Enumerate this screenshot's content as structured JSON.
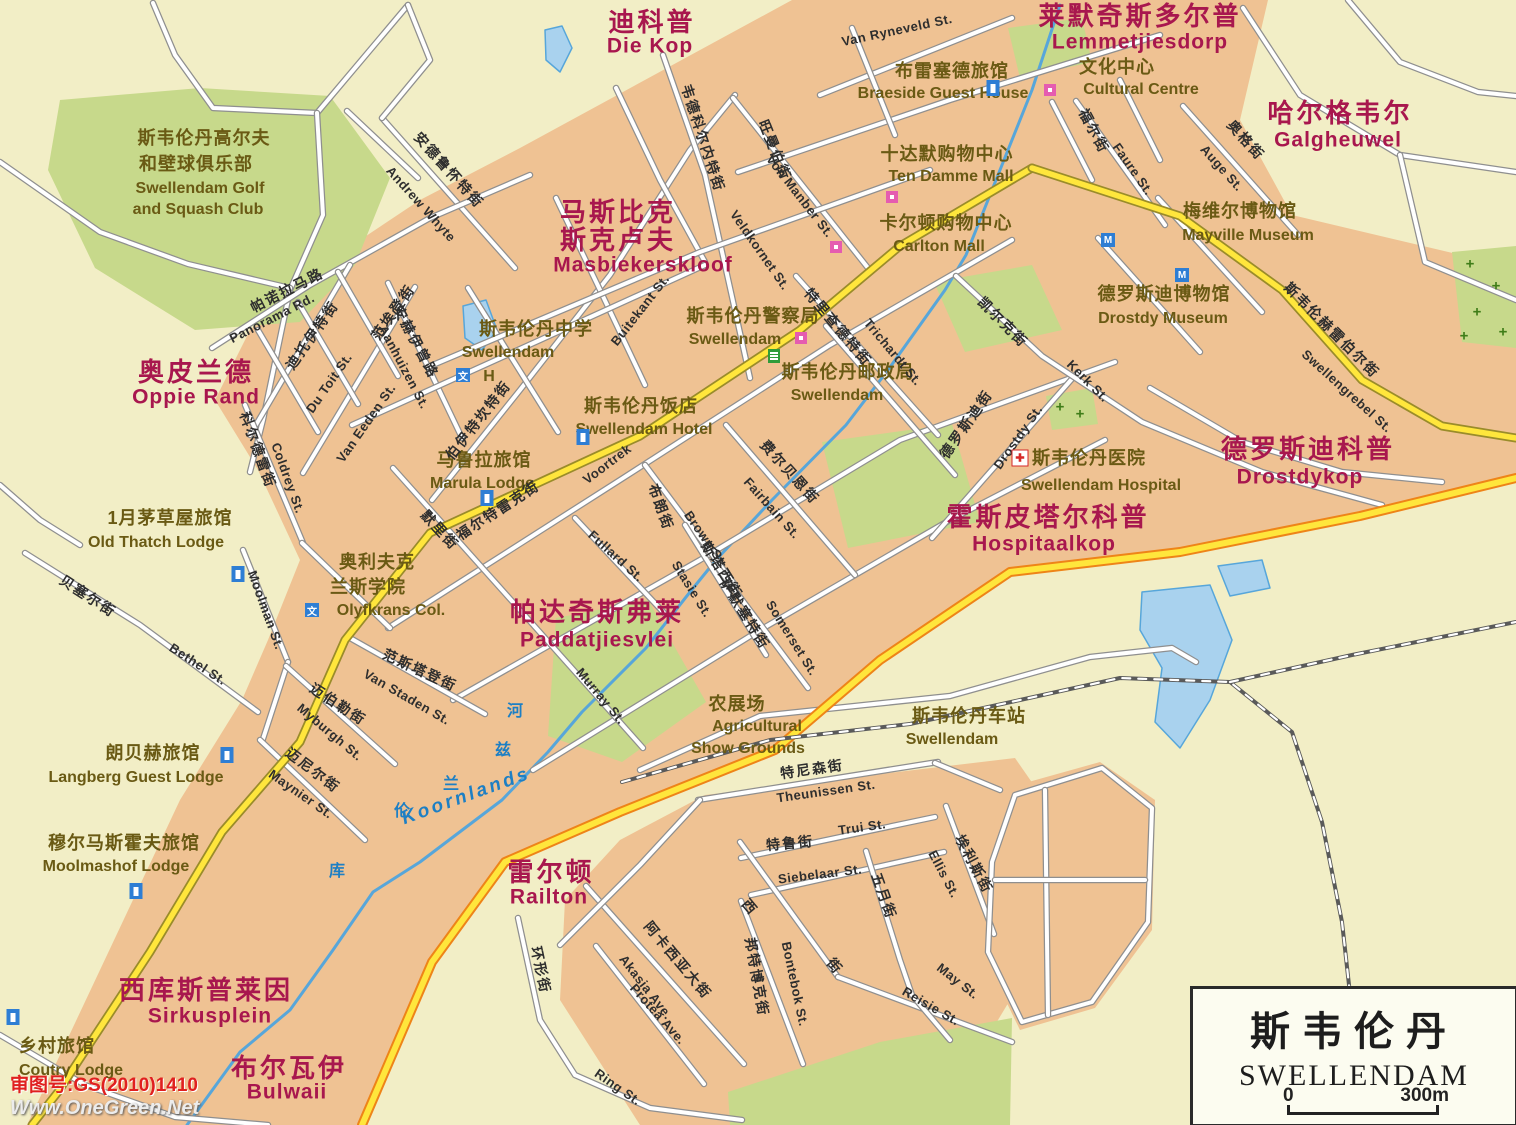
{
  "title_box": {
    "zh": "斯韦伦丹",
    "en": "SWELLENDAM",
    "scale_start": "0",
    "scale_end": "300m"
  },
  "credits": {
    "approval": "审图号:GS(2010)1410",
    "watermark": "Www.OneGreen.Net"
  },
  "colors": {
    "rural": "#f2eec6",
    "urban": "#efc293",
    "green": "#c7d98b",
    "water": "#a9d2ee",
    "river": "#57a6da",
    "roadc": "#8f8f8f",
    "yellow": "#ffe63c",
    "yellowc": "#9a8c2a",
    "hwyc": "#ee8418",
    "rail": "#5a5a5a",
    "district": "#a8174e",
    "poi": "#6a5a14",
    "street": "#2e2e2e",
    "waterlbl": "#1d7fc4",
    "approval": "#e02020",
    "watermark": "#ececec"
  },
  "labels": [
    {
      "t": "迪科普",
      "x": 652,
      "y": 22,
      "c": "dz"
    },
    {
      "t": "Die Kop",
      "x": 650,
      "y": 46,
      "c": "de"
    },
    {
      "t": "莱默奇斯多尔普",
      "x": 1140,
      "y": 16,
      "c": "dz"
    },
    {
      "t": "Lemmetjiesdorp",
      "x": 1140,
      "y": 42,
      "c": "de"
    },
    {
      "t": "哈尔格韦尔",
      "x": 1340,
      "y": 113,
      "c": "dz"
    },
    {
      "t": "Galgheuwel",
      "x": 1338,
      "y": 140,
      "c": "de"
    },
    {
      "t": "马斯比克",
      "x": 618,
      "y": 212,
      "c": "dz"
    },
    {
      "t": "斯克卢夫",
      "x": 618,
      "y": 240,
      "c": "dz"
    },
    {
      "t": "Masbiekerskloof",
      "x": 643,
      "y": 265,
      "c": "de"
    },
    {
      "t": "奥皮兰德",
      "x": 196,
      "y": 372,
      "c": "dz"
    },
    {
      "t": "Oppie Rand",
      "x": 196,
      "y": 397,
      "c": "de"
    },
    {
      "t": "德罗斯迪科普",
      "x": 1308,
      "y": 449,
      "c": "dz"
    },
    {
      "t": "Drostdykop",
      "x": 1300,
      "y": 477,
      "c": "de"
    },
    {
      "t": "霍斯皮塔尔科普",
      "x": 1048,
      "y": 517,
      "c": "dz"
    },
    {
      "t": "Hospitaalkop",
      "x": 1044,
      "y": 544,
      "c": "de"
    },
    {
      "t": "帕达奇斯弗莱",
      "x": 597,
      "y": 612,
      "c": "dz"
    },
    {
      "t": "Paddatjiesvlei",
      "x": 597,
      "y": 640,
      "c": "de"
    },
    {
      "t": "西库斯普莱因",
      "x": 206,
      "y": 990,
      "c": "dz"
    },
    {
      "t": "Sirkusplein",
      "x": 210,
      "y": 1016,
      "c": "de"
    },
    {
      "t": "布尔瓦伊",
      "x": 289,
      "y": 1068,
      "c": "dz"
    },
    {
      "t": "Bulwaii",
      "x": 287,
      "y": 1092,
      "c": "de"
    },
    {
      "t": "雷尔顿",
      "x": 551,
      "y": 872,
      "c": "dz"
    },
    {
      "t": "Railton",
      "x": 549,
      "y": 897,
      "c": "de"
    },
    {
      "t": "斯韦伦丹高尔夫",
      "x": 204,
      "y": 138,
      "c": "pz"
    },
    {
      "t": "和壁球俱乐部",
      "x": 196,
      "y": 164,
      "c": "pz"
    },
    {
      "t": "Swellendam Golf",
      "x": 200,
      "y": 189,
      "c": "pe"
    },
    {
      "t": "and Squash Club",
      "x": 198,
      "y": 210,
      "c": "pe"
    },
    {
      "t": "布雷塞德旅馆",
      "x": 952,
      "y": 71,
      "c": "pz"
    },
    {
      "t": "Braeside Guest House",
      "x": 943,
      "y": 94,
      "c": "pe"
    },
    {
      "t": "文化中心",
      "x": 1117,
      "y": 67,
      "c": "pz"
    },
    {
      "t": "Cultural Centre",
      "x": 1141,
      "y": 90,
      "c": "pe"
    },
    {
      "t": "十达默购物中心",
      "x": 947,
      "y": 154,
      "c": "pz"
    },
    {
      "t": "Ten Damme Mall",
      "x": 951,
      "y": 177,
      "c": "pe"
    },
    {
      "t": "卡尔顿购物中心",
      "x": 946,
      "y": 223,
      "c": "pz"
    },
    {
      "t": "Carlton Mall",
      "x": 939,
      "y": 247,
      "c": "pe"
    },
    {
      "t": "梅维尔博物馆",
      "x": 1240,
      "y": 211,
      "c": "pz"
    },
    {
      "t": "Mayville Museum",
      "x": 1248,
      "y": 236,
      "c": "pe"
    },
    {
      "t": "德罗斯迪博物馆",
      "x": 1164,
      "y": 294,
      "c": "pz"
    },
    {
      "t": "Drostdy Museum",
      "x": 1163,
      "y": 319,
      "c": "pe"
    },
    {
      "t": "斯韦伦丹中学",
      "x": 536,
      "y": 329,
      "c": "pz"
    },
    {
      "t": "Swellendam",
      "x": 508,
      "y": 353,
      "c": "pe"
    },
    {
      "t": "H",
      "x": 489,
      "y": 377,
      "c": "pe"
    },
    {
      "t": "斯韦伦丹警察局",
      "x": 753,
      "y": 316,
      "c": "pz"
    },
    {
      "t": "Swellendam",
      "x": 735,
      "y": 340,
      "c": "pe"
    },
    {
      "t": "斯韦伦丹邮政局",
      "x": 848,
      "y": 372,
      "c": "pz"
    },
    {
      "t": "Swellendam",
      "x": 837,
      "y": 396,
      "c": "pe"
    },
    {
      "t": "斯韦伦丹饭店",
      "x": 641,
      "y": 406,
      "c": "pz"
    },
    {
      "t": "Swellendam Hotel",
      "x": 644,
      "y": 430,
      "c": "pe"
    },
    {
      "t": "马鲁拉旅馆",
      "x": 484,
      "y": 460,
      "c": "pz"
    },
    {
      "t": "Marula Lodge",
      "x": 482,
      "y": 484,
      "c": "pe"
    },
    {
      "t": "1月茅草屋旅馆",
      "x": 170,
      "y": 518,
      "c": "pz"
    },
    {
      "t": "Old Thatch Lodge",
      "x": 156,
      "y": 543,
      "c": "pe"
    },
    {
      "t": "奥利夫克",
      "x": 377,
      "y": 562,
      "c": "pz"
    },
    {
      "t": "兰斯学院",
      "x": 368,
      "y": 587,
      "c": "pz"
    },
    {
      "t": "Olyfkrans Col.",
      "x": 391,
      "y": 611,
      "c": "pe"
    },
    {
      "t": "朗贝赫旅馆",
      "x": 153,
      "y": 753,
      "c": "pz"
    },
    {
      "t": "Langberg Guest Lodge",
      "x": 136,
      "y": 778,
      "c": "pe"
    },
    {
      "t": "穆尔马斯霍夫旅馆",
      "x": 124,
      "y": 843,
      "c": "pz"
    },
    {
      "t": "Moolmashof Lodge",
      "x": 116,
      "y": 867,
      "c": "pe"
    },
    {
      "t": "乡村旅馆",
      "x": 57,
      "y": 1046,
      "c": "pz"
    },
    {
      "t": "Coutry Lodge",
      "x": 71,
      "y": 1071,
      "c": "pe"
    },
    {
      "t": "农展场",
      "x": 737,
      "y": 704,
      "c": "pz"
    },
    {
      "t": "Agricultural",
      "x": 757,
      "y": 727,
      "c": "pe"
    },
    {
      "t": "Show Grounds",
      "x": 748,
      "y": 749,
      "c": "pe"
    },
    {
      "t": "斯韦伦丹车站",
      "x": 969,
      "y": 716,
      "c": "pz"
    },
    {
      "t": "Swellendam",
      "x": 952,
      "y": 740,
      "c": "pe"
    },
    {
      "t": "斯韦伦丹医院",
      "x": 1089,
      "y": 458,
      "c": "pz"
    },
    {
      "t": "Swellendam Hospital",
      "x": 1101,
      "y": 486,
      "c": "pe"
    },
    {
      "t": "Van Ryneveld St.",
      "x": 897,
      "y": 30,
      "c": "se",
      "r": -12
    },
    {
      "t": "韦德科尔内特街",
      "x": 703,
      "y": 138,
      "c": "sz",
      "r": 72
    },
    {
      "t": "Veldkornet St.",
      "x": 760,
      "y": 250,
      "c": "se",
      "r": 55
    },
    {
      "t": "旺曼伯街",
      "x": 775,
      "y": 150,
      "c": "sz",
      "r": 68
    },
    {
      "t": "Von Manber St.",
      "x": 800,
      "y": 196,
      "c": "se",
      "r": 52
    },
    {
      "t": "安德鲁怀特街",
      "x": 449,
      "y": 170,
      "c": "sz",
      "r": 48
    },
    {
      "t": "Andrew Whyte",
      "x": 421,
      "y": 204,
      "c": "se",
      "r": 48
    },
    {
      "t": "帕诺拉马路",
      "x": 287,
      "y": 290,
      "c": "sz",
      "r": -27
    },
    {
      "t": "Panorama Rd.",
      "x": 272,
      "y": 318,
      "c": "se",
      "r": -27
    },
    {
      "t": "安赫伊曾路",
      "x": 416,
      "y": 342,
      "c": "sz",
      "r": 62
    },
    {
      "t": "Aanhuizen St.",
      "x": 404,
      "y": 367,
      "c": "se",
      "r": 62
    },
    {
      "t": "科尔德雷街",
      "x": 258,
      "y": 450,
      "c": "sz",
      "r": 70
    },
    {
      "t": "Coldrey St.",
      "x": 288,
      "y": 478,
      "c": "se",
      "r": 70
    },
    {
      "t": "迪托伊特街",
      "x": 312,
      "y": 335,
      "c": "sz",
      "r": -55
    },
    {
      "t": "Du Toit St.",
      "x": 329,
      "y": 383,
      "c": "se",
      "r": -55
    },
    {
      "t": "范埃登街",
      "x": 393,
      "y": 312,
      "c": "sz",
      "r": -55
    },
    {
      "t": "Van Eeden St.",
      "x": 366,
      "y": 423,
      "c": "se",
      "r": -55
    },
    {
      "t": "伯伊特坎特街",
      "x": 478,
      "y": 420,
      "c": "sz",
      "r": -52
    },
    {
      "t": "Buitekant St.",
      "x": 640,
      "y": 310,
      "c": "se",
      "r": -52
    },
    {
      "t": "福尔特雷克街",
      "x": 498,
      "y": 510,
      "c": "sz",
      "r": -33
    },
    {
      "t": "Voortrek",
      "x": 607,
      "y": 464,
      "c": "se",
      "r": -37
    },
    {
      "t": "默里街",
      "x": 440,
      "y": 530,
      "c": "sz",
      "r": 47
    },
    {
      "t": "Murray St.",
      "x": 601,
      "y": 696,
      "c": "se",
      "r": 50
    },
    {
      "t": "Moolman St.",
      "x": 266,
      "y": 610,
      "c": "se",
      "r": 70
    },
    {
      "t": "贝塞尔街",
      "x": 88,
      "y": 596,
      "c": "sz",
      "r": 33
    },
    {
      "t": "Bethel St.",
      "x": 198,
      "y": 664,
      "c": "se",
      "r": 33
    },
    {
      "t": "范斯塔登街",
      "x": 420,
      "y": 670,
      "c": "sz",
      "r": 25
    },
    {
      "t": "Van Staden St.",
      "x": 407,
      "y": 697,
      "c": "se",
      "r": 30
    },
    {
      "t": "迈伯勒街",
      "x": 338,
      "y": 704,
      "c": "sz",
      "r": 33
    },
    {
      "t": "Myburgh St.",
      "x": 330,
      "y": 732,
      "c": "se",
      "r": 40
    },
    {
      "t": "迈尼尔街",
      "x": 313,
      "y": 770,
      "c": "sz",
      "r": 37
    },
    {
      "t": "Maynier St.",
      "x": 301,
      "y": 794,
      "c": "se",
      "r": 35
    },
    {
      "t": "Fullard St.",
      "x": 616,
      "y": 556,
      "c": "se",
      "r": 42
    },
    {
      "t": "布朗街",
      "x": 661,
      "y": 507,
      "c": "sz",
      "r": 70
    },
    {
      "t": "Brown St.",
      "x": 706,
      "y": 539,
      "c": "se",
      "r": 55
    },
    {
      "t": "斯塔西街",
      "x": 722,
      "y": 570,
      "c": "sz",
      "r": 58
    },
    {
      "t": "Stasie St.",
      "x": 692,
      "y": 589,
      "c": "se",
      "r": 58
    },
    {
      "t": "费尔贝恩街",
      "x": 790,
      "y": 472,
      "c": "sz",
      "r": 48
    },
    {
      "t": "Fairbain St.",
      "x": 772,
      "y": 508,
      "c": "se",
      "r": 48
    },
    {
      "t": "萨默塞特街",
      "x": 745,
      "y": 614,
      "c": "sz",
      "r": 58
    },
    {
      "t": "Somerset St.",
      "x": 792,
      "y": 638,
      "c": "se",
      "r": 58
    },
    {
      "t": "特里查德特街",
      "x": 838,
      "y": 327,
      "c": "sz",
      "r": 50
    },
    {
      "t": "Trichardt St.",
      "x": 893,
      "y": 352,
      "c": "se",
      "r": 50
    },
    {
      "t": "凯尔克街",
      "x": 1003,
      "y": 322,
      "c": "sz",
      "r": 45
    },
    {
      "t": "Kerk St.",
      "x": 1088,
      "y": 381,
      "c": "se",
      "r": 45
    },
    {
      "t": "德罗斯迪街",
      "x": 966,
      "y": 424,
      "c": "sz",
      "r": -55
    },
    {
      "t": "Drostdy St.",
      "x": 1018,
      "y": 437,
      "c": "se",
      "r": -55
    },
    {
      "t": "福尔街",
      "x": 1094,
      "y": 131,
      "c": "sz",
      "r": 62
    },
    {
      "t": "Faure St.",
      "x": 1133,
      "y": 169,
      "c": "se",
      "r": 55
    },
    {
      "t": "奥格街",
      "x": 1246,
      "y": 140,
      "c": "sz",
      "r": 48
    },
    {
      "t": "Auge St.",
      "x": 1222,
      "y": 168,
      "c": "se",
      "r": 48
    },
    {
      "t": "斯韦伦赫雷伯尔街",
      "x": 1332,
      "y": 330,
      "c": "sz",
      "r": 45
    },
    {
      "t": "Swellengrebel St.",
      "x": 1347,
      "y": 391,
      "c": "se",
      "r": 42
    },
    {
      "t": "特尼森街",
      "x": 812,
      "y": 769,
      "c": "sz",
      "r": -8
    },
    {
      "t": "Theunissen St.",
      "x": 826,
      "y": 791,
      "c": "se",
      "r": -8
    },
    {
      "t": "特鲁街",
      "x": 790,
      "y": 843,
      "c": "sz",
      "r": -5
    },
    {
      "t": "Trui St.",
      "x": 862,
      "y": 827,
      "c": "se",
      "r": -8
    },
    {
      "t": "Siebelaar St.",
      "x": 820,
      "y": 874,
      "c": "se",
      "r": -7
    },
    {
      "t": "五月街",
      "x": 884,
      "y": 896,
      "c": "sz",
      "r": 70
    },
    {
      "t": "May St.",
      "x": 958,
      "y": 981,
      "c": "se",
      "r": 38
    },
    {
      "t": "埃利斯街",
      "x": 974,
      "y": 864,
      "c": "sz",
      "r": 62
    },
    {
      "t": "Ellis St.",
      "x": 944,
      "y": 874,
      "c": "se",
      "r": 62
    },
    {
      "t": "Reisie St.",
      "x": 931,
      "y": 1006,
      "c": "se",
      "r": 30
    },
    {
      "t": "西",
      "x": 750,
      "y": 907,
      "c": "sz",
      "r": 50
    },
    {
      "t": "街",
      "x": 835,
      "y": 966,
      "c": "sz",
      "r": 50
    },
    {
      "t": "邦特博克街",
      "x": 757,
      "y": 977,
      "c": "sz",
      "r": 80
    },
    {
      "t": "Bontebok St.",
      "x": 795,
      "y": 984,
      "c": "se",
      "r": 78
    },
    {
      "t": "阿卡西亚大街",
      "x": 678,
      "y": 960,
      "c": "sz",
      "r": 50
    },
    {
      "t": "Akasia Ave.",
      "x": 646,
      "y": 987,
      "c": "se",
      "r": 52
    },
    {
      "t": "Protea Ave.",
      "x": 658,
      "y": 1014,
      "c": "se",
      "r": 48
    },
    {
      "t": "环形街",
      "x": 541,
      "y": 970,
      "c": "sz",
      "r": 78
    },
    {
      "t": "Ring St.",
      "x": 618,
      "y": 1087,
      "c": "se",
      "r": 35
    },
    {
      "t": "库",
      "x": 337,
      "y": 872,
      "c": "wz"
    },
    {
      "t": "伦",
      "x": 402,
      "y": 812,
      "c": "wz"
    },
    {
      "t": "兰",
      "x": 451,
      "y": 785,
      "c": "wz"
    },
    {
      "t": "兹",
      "x": 503,
      "y": 751,
      "c": "wz"
    },
    {
      "t": "河",
      "x": 515,
      "y": 712,
      "c": "wz"
    },
    {
      "t": "Koornlands",
      "x": 466,
      "y": 796,
      "c": "we",
      "r": -20
    },
    {
      "t": "+",
      "x": 1470,
      "y": 264,
      "c": "cr"
    },
    {
      "t": "+",
      "x": 1496,
      "y": 286,
      "c": "cr"
    },
    {
      "t": "+",
      "x": 1477,
      "y": 312,
      "c": "cr"
    },
    {
      "t": "+",
      "x": 1503,
      "y": 332,
      "c": "cr"
    },
    {
      "t": "+",
      "x": 1464,
      "y": 336,
      "c": "cr"
    },
    {
      "t": "+",
      "x": 1060,
      "y": 407,
      "c": "cr"
    },
    {
      "t": "+",
      "x": 1080,
      "y": 414,
      "c": "cr"
    }
  ],
  "icons": [
    {
      "kind": "hotel",
      "x": 993,
      "y": 88
    },
    {
      "kind": "hotel",
      "x": 583,
      "y": 437
    },
    {
      "kind": "hotel",
      "x": 487,
      "y": 498
    },
    {
      "kind": "hotel",
      "x": 238,
      "y": 574
    },
    {
      "kind": "hotel",
      "x": 227,
      "y": 755
    },
    {
      "kind": "hotel",
      "x": 136,
      "y": 891
    },
    {
      "kind": "hotel",
      "x": 13,
      "y": 1017
    },
    {
      "kind": "mall",
      "x": 892,
      "y": 197
    },
    {
      "kind": "mall",
      "x": 836,
      "y": 247
    },
    {
      "kind": "mall",
      "x": 1050,
      "y": 90
    },
    {
      "kind": "police",
      "x": 801,
      "y": 338
    },
    {
      "kind": "post",
      "x": 774,
      "y": 356
    },
    {
      "kind": "museum",
      "x": 1108,
      "y": 240
    },
    {
      "kind": "museum",
      "x": 1182,
      "y": 275
    },
    {
      "kind": "school",
      "x": 463,
      "y": 375
    },
    {
      "kind": "school",
      "x": 312,
      "y": 610
    },
    {
      "kind": "hospital",
      "x": 1020,
      "y": 458
    }
  ]
}
